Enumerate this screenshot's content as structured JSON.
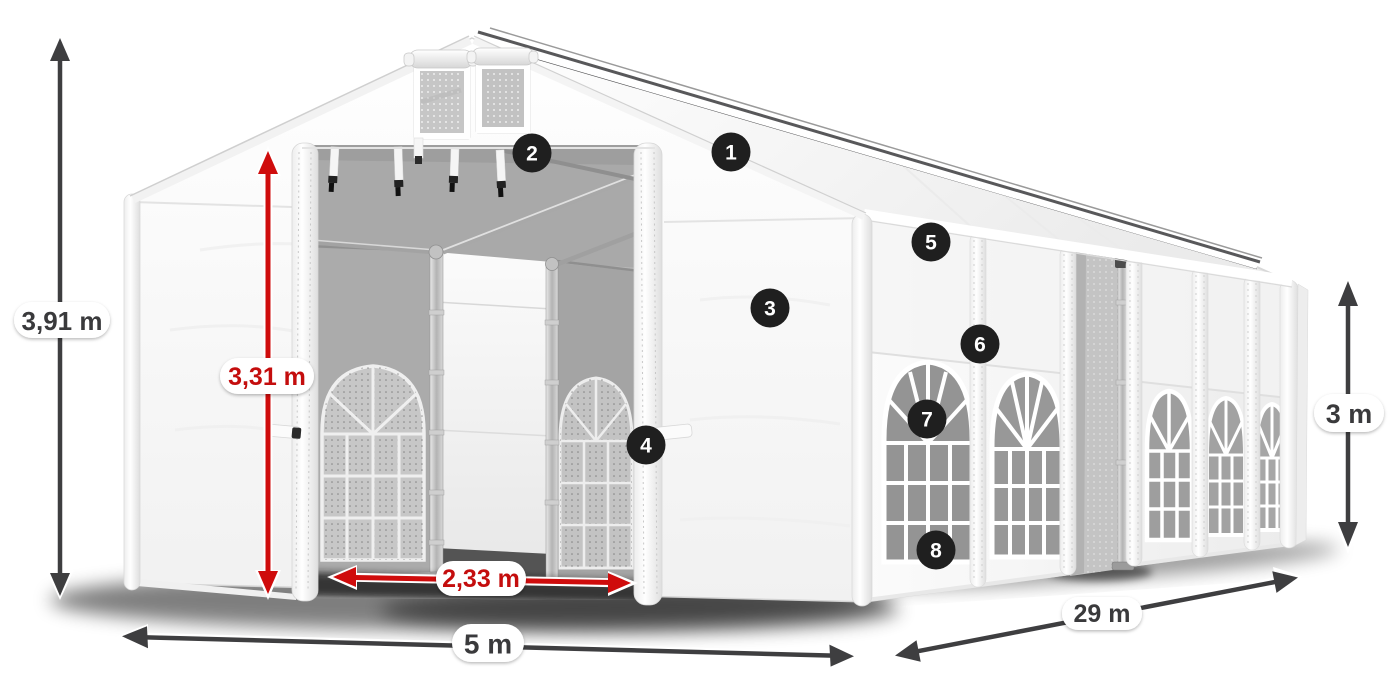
{
  "diagram": {
    "subject": "white storage marquee tent with dimension annotations",
    "colors": {
      "dimension_arrow": "#3e3e40",
      "highlight_arrow": "#cf0c0c",
      "label_pill_background": "#ffffff",
      "label_text_dark": "#3a3a3c",
      "label_text_red": "#c40d0d",
      "badge_background": "#1f1f1f",
      "badge_text": "#ffffff",
      "tent_fabric": "#fafafa",
      "interior_shade": "#b0b0b0"
    },
    "dimensions": {
      "total_height": {
        "value": "3,91 m",
        "style": "dark",
        "orientation": "vertical"
      },
      "entrance_height": {
        "value": "3,31 m",
        "style": "red",
        "orientation": "vertical"
      },
      "entrance_width": {
        "value": "2,33 m",
        "style": "red",
        "orientation": "horizontal"
      },
      "front_width": {
        "value": "5 m",
        "style": "dark",
        "orientation": "horizontal"
      },
      "side_length": {
        "value": "29 m",
        "style": "dark",
        "orientation": "diagonal"
      },
      "side_height": {
        "value": "3 m",
        "style": "dark",
        "orientation": "vertical"
      }
    },
    "callouts": [
      {
        "number": "1"
      },
      {
        "number": "2"
      },
      {
        "number": "3"
      },
      {
        "number": "4"
      },
      {
        "number": "5"
      },
      {
        "number": "6"
      },
      {
        "number": "7"
      },
      {
        "number": "8"
      }
    ]
  }
}
